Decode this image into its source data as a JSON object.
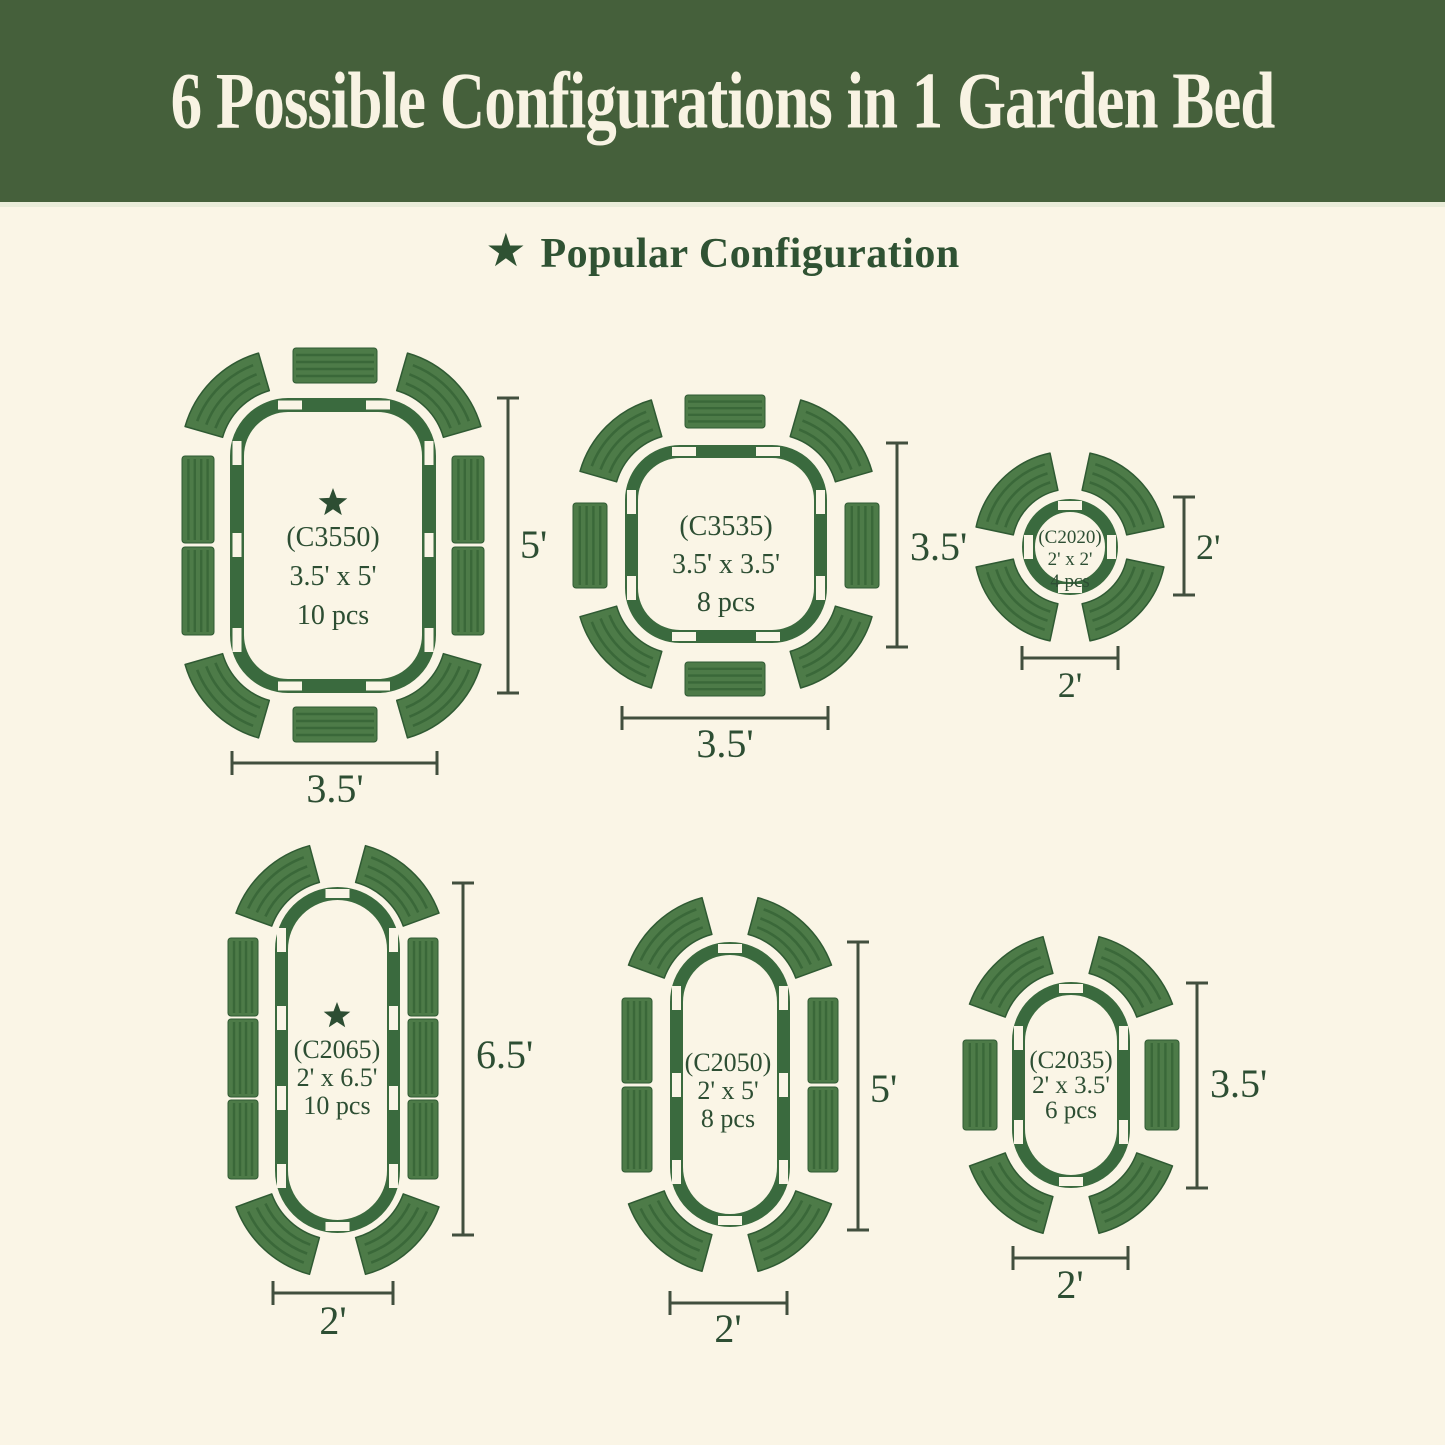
{
  "header": {
    "title": "6 Possible Configurations in 1 Garden Bed"
  },
  "legend": {
    "star_icon": "★",
    "label": "Popular Configuration"
  },
  "colors": {
    "banner_green": "#45603b",
    "banner_text": "#f8f3e3",
    "background_cream": "#faf5e6",
    "bed_outline_green": "#3a6a3e",
    "panel_green": "#4d7b48",
    "panel_stripe": "#3a6839",
    "panel_edge": "#2f5a33",
    "text_green": "#2d4e33",
    "dimension_line": "#414f3e"
  },
  "diagrams": [
    {
      "id": "C3550",
      "code_label": "(C3550)",
      "size_label": "3.5' x 5'",
      "pieces_label": "10 pcs",
      "popular": true,
      "height_label": "5'",
      "width_label": "3.5'"
    },
    {
      "id": "C3535",
      "code_label": "(C3535)",
      "size_label": "3.5' x 3.5'",
      "pieces_label": "8 pcs",
      "popular": false,
      "height_label": "3.5'",
      "width_label": "3.5'"
    },
    {
      "id": "C2020",
      "code_label": "(C2020)",
      "size_label": "2' x 2'",
      "pieces_label": "4 pcs",
      "popular": false,
      "height_label": "2'",
      "width_label": "2'"
    },
    {
      "id": "C2065",
      "code_label": "(C2065)",
      "size_label": "2' x 6.5'",
      "pieces_label": "10 pcs",
      "popular": true,
      "height_label": "6.5'",
      "width_label": "2'"
    },
    {
      "id": "C2050",
      "code_label": "(C2050)",
      "size_label": "2' x 5'",
      "pieces_label": "8 pcs",
      "popular": false,
      "height_label": "5'",
      "width_label": "2'"
    },
    {
      "id": "C2035",
      "code_label": "(C2035)",
      "size_label": "2' x 3.5'",
      "pieces_label": "6 pcs",
      "popular": false,
      "height_label": "3.5'",
      "width_label": "2'"
    }
  ]
}
